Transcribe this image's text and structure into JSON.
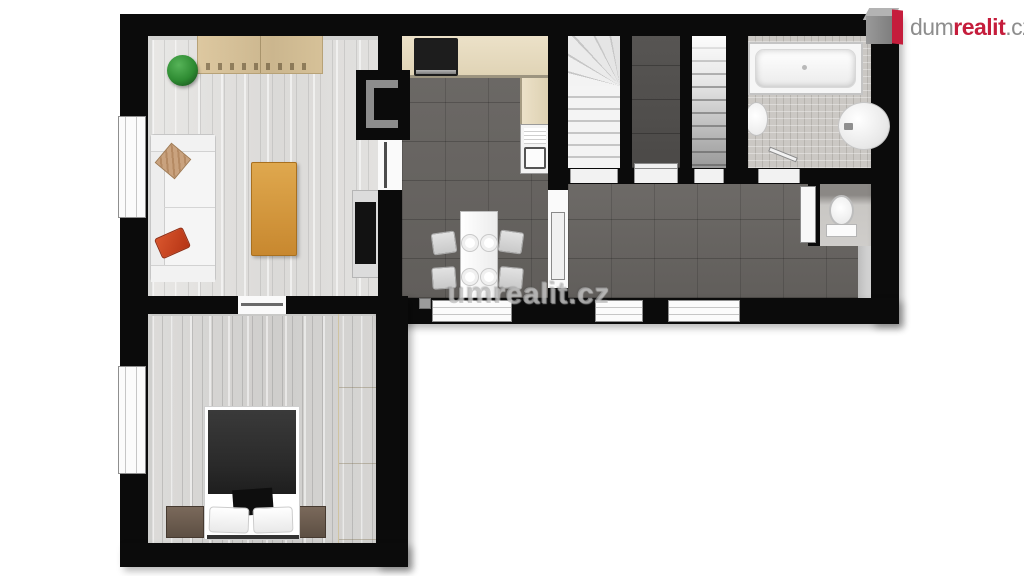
{
  "branding": {
    "logo_prefix": "dum",
    "logo_accent": "realit",
    "logo_suffix": ".cz",
    "logo_icon": "house-3d-icon"
  },
  "watermark": {
    "text": "umrealit.cz"
  },
  "palette": {
    "wall": "#0b0b0b",
    "floor_wood_light": "#e3e2e0",
    "floor_wood_bedroom": "#d7d6d4",
    "floor_tile_dark": "#696663",
    "floor_tile_pantry": "#52504e",
    "floor_tile_bath": "#cbc8c4",
    "counter_beige": "#e8ddc2",
    "cabinet_wood": "#d9c49c",
    "wardrobe_cream": "#f3ebd3",
    "table_oak": "#d79b3f",
    "sofa_white": "#f7f7f7",
    "pillow_red": "#cc4422",
    "pillow_tan": "#c9a27e",
    "plant_green": "#2e8b32",
    "logo_gray": "#8d8d8d",
    "logo_red": "#c51d3c"
  },
  "plan": {
    "type": "apartment-floor-plan-top-view",
    "rooms": [
      {
        "name": "living-room",
        "furniture": [
          "sofa",
          "throw-pillows",
          "coffee-table",
          "sideboard",
          "plant",
          "tv-stand",
          "tv"
        ]
      },
      {
        "name": "kitchen-dining",
        "furniture": [
          "cooktop",
          "l-counter",
          "kitchen-sink",
          "dining-table",
          "plates",
          "chairs"
        ]
      },
      {
        "name": "staircase-up"
      },
      {
        "name": "pantry"
      },
      {
        "name": "staircase-down"
      },
      {
        "name": "bathroom",
        "furniture": [
          "bathtub",
          "washbasin",
          "water-heater"
        ]
      },
      {
        "name": "wc",
        "furniture": [
          "toilet"
        ]
      },
      {
        "name": "hallway"
      },
      {
        "name": "bedroom",
        "furniture": [
          "double-bed",
          "pillows",
          "nightstand-left",
          "nightstand-right",
          "wardrobe"
        ]
      }
    ]
  }
}
